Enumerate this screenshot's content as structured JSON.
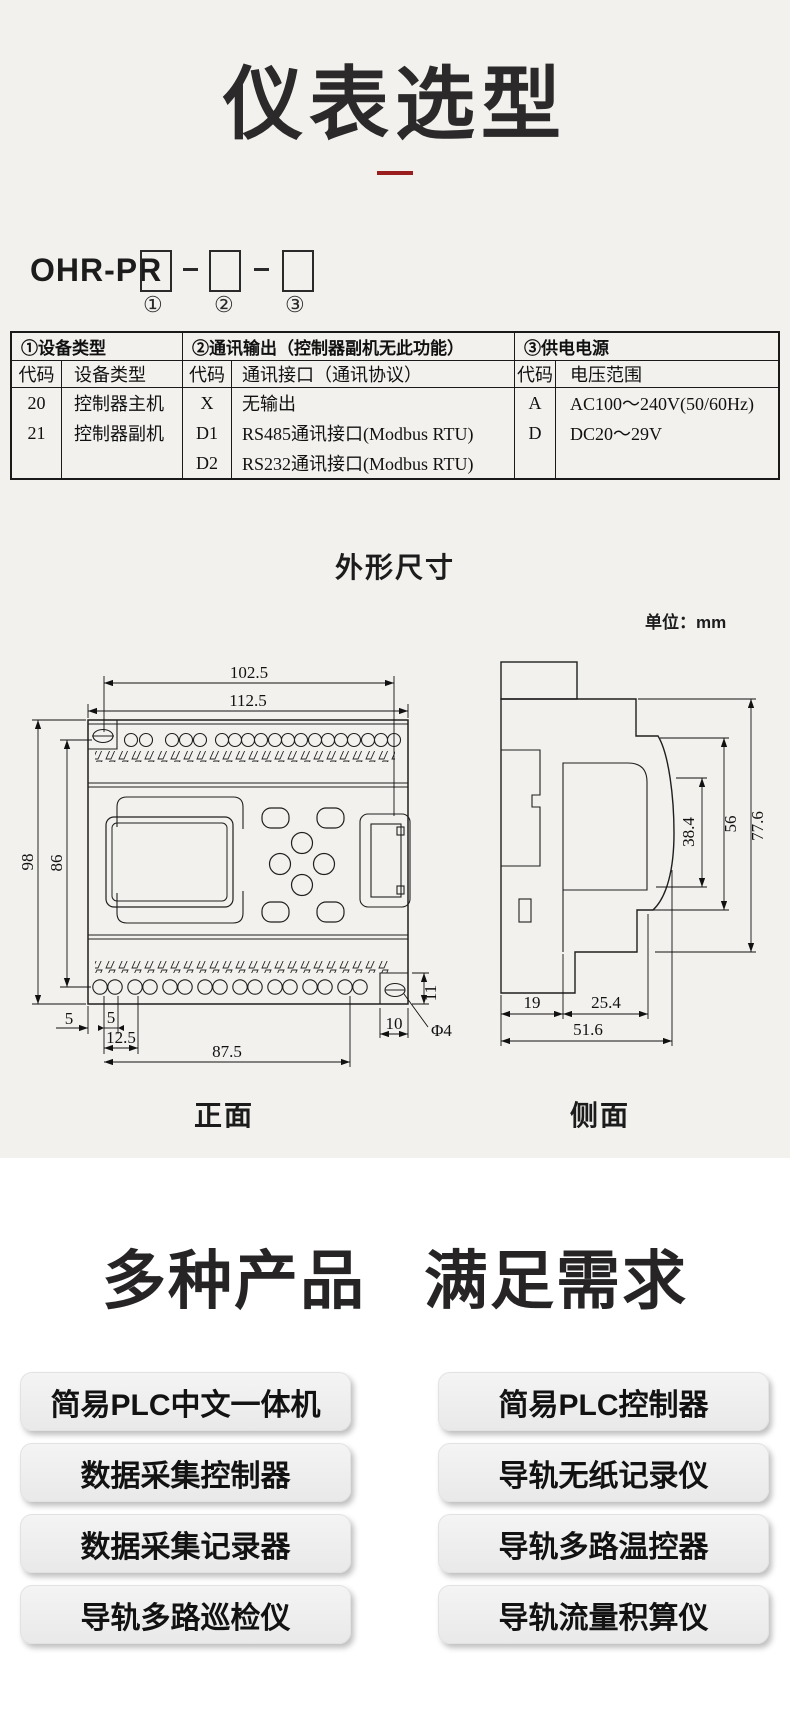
{
  "title": {
    "text": "仪表选型",
    "underline_color": "#9b1e1e"
  },
  "model_code": {
    "prefix": "OHR-PR",
    "positions": [
      "①",
      "②",
      "③"
    ]
  },
  "selection_table": {
    "sections": [
      {
        "header": "①设备类型",
        "col_headers": [
          "代码",
          "设备类型"
        ],
        "rows": [
          [
            "20",
            "控制器主机"
          ],
          [
            "21",
            "控制器副机"
          ]
        ]
      },
      {
        "header": "②通讯输出（控制器副机无此功能）",
        "col_headers": [
          "代码",
          "通讯接口（通讯协议）"
        ],
        "rows": [
          [
            "X",
            "无输出"
          ],
          [
            "D1",
            "RS485通讯接口(Modbus RTU)"
          ],
          [
            "D2",
            "RS232通讯接口(Modbus RTU)"
          ]
        ]
      },
      {
        "header": "③供电电源",
        "col_headers": [
          "代码",
          "电压范围"
        ],
        "rows": [
          [
            "A",
            "AC100～240V(50/60Hz)"
          ],
          [
            "D",
            "DC20～29V"
          ]
        ]
      }
    ]
  },
  "dimensions": {
    "heading": "外形尺寸",
    "unit_label": "单位：mm",
    "front_label": "正面",
    "side_label": "侧面",
    "front": {
      "width_top": "102.5",
      "width_full": "112.5",
      "height_full": "98",
      "height_inner": "86",
      "offset_edge": "5",
      "offset_hole": "5",
      "offset_pair": "12.5",
      "width_bottom": "87.5",
      "block_width": "10",
      "block_height": "11",
      "hole_diameter": "Φ4"
    },
    "side": {
      "depth_front": "38.4",
      "depth_mid": "56",
      "depth_full": "77.6",
      "base_left": "19",
      "base_mid": "25.4",
      "base_full": "51.6"
    }
  },
  "products": {
    "heading_part1": "多种产品",
    "heading_part2": "满足需求",
    "left": [
      "简易PLC中文一体机",
      "数据采集控制器",
      "数据采集记录器",
      "导轨多路巡检仪"
    ],
    "right": [
      "简易PLC控制器",
      "导轨无纸记录仪",
      "导轨多路温控器",
      "导轨流量积算仪"
    ]
  }
}
